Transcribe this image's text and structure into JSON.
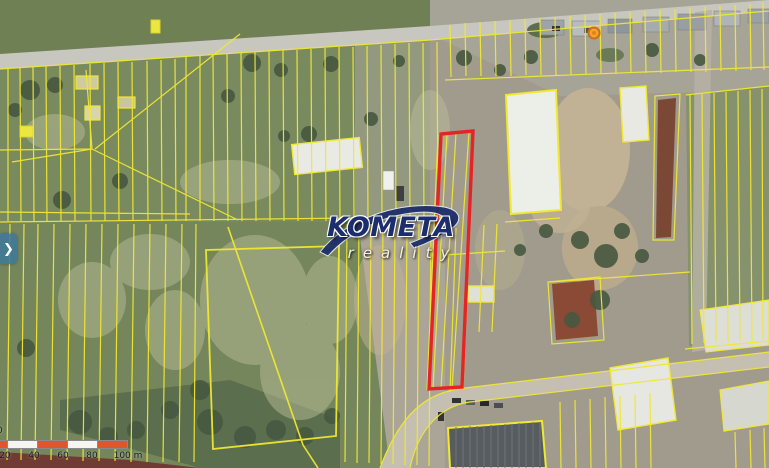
{
  "map_viewer": {
    "type": "cadastral-satellite-map",
    "watermark": {
      "brand": "KOMETA",
      "tagline": "reality"
    },
    "panel_toggle": {
      "icon": "chevron-right-icon",
      "glyph": "❯"
    },
    "scale_bar": {
      "partial_zero": "0",
      "labels": [
        "20",
        "40",
        "60",
        "80",
        "100 m"
      ]
    },
    "highlighted_parcel": {
      "outline_color": "#e42525"
    },
    "cadastral_lines_color": "#f0e832",
    "poi_marker_color": "#f4a426",
    "panel_toggle_color": "#3e7a99",
    "scale_segment_color": "#e0552f"
  }
}
